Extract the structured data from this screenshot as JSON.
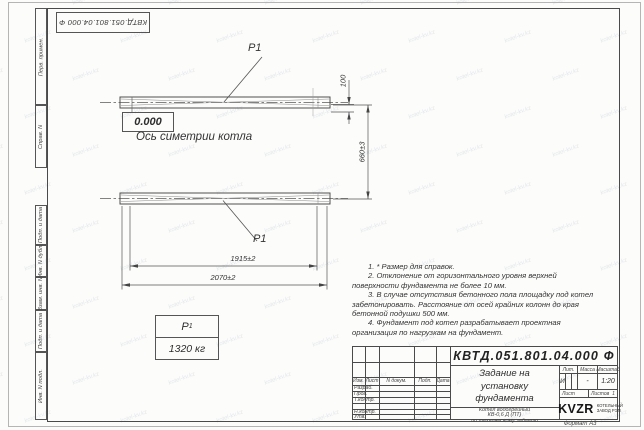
{
  "page": {
    "stamp_rotated": "КВТД.051.801.04.000  Ф",
    "format_label": "Формат А3",
    "watermark_text": "kotel-kv.kz"
  },
  "margin_labels": {
    "perv_primen": "Перв. примен.",
    "sprav_n": "Справ. N",
    "podp_data_1": "Подп. и дата",
    "inv_dubl": "Инв. N дубл.",
    "vzam_inv": "Взам. инв. N",
    "podp_data_2": "Подп. и дата",
    "inv_podl": "Инв. N подл."
  },
  "drawing": {
    "p1_top": "P1",
    "p1_bottom": "P1",
    "level_mark": "0.000",
    "axis_label": "Ось симетрии котла",
    "dims": {
      "inner_width": "1915±2",
      "outer_width": "2070±2",
      "vertical_gap": "660±3",
      "thickness": "100"
    },
    "mass_table": {
      "symbol": "P",
      "symbol_sub": "1",
      "value": "1320 кг"
    }
  },
  "notes": {
    "n1": "1. * Размер для справок.",
    "n2": "2. Отклонение от горизонтального уровня верхней поверхности фундамента не более 10 мм.",
    "n3": "3. В случае отсутствия бетонного пола площадку под котел забетонировать. Расстояние от осей крайних колонн до края бетонной подушки 500 мм.",
    "n4": "4. Фундамент под котел разрабатывает проектная организация по нагрузкам на фундамент."
  },
  "title_block": {
    "doc_number": "КВТД.051.801.04.000  Ф",
    "title_lines": {
      "l1": "Задание на",
      "l2": "установку",
      "l3": "фундамента"
    },
    "subtitle_lines": {
      "l1": "Котел водогрейный",
      "l2": "КВ-0,6 Д (ПТ)",
      "l3": "по техническому заданию"
    },
    "col_headers": {
      "izm": "Изм.",
      "list": "Лист",
      "doc": "N докум.",
      "podp": "Подп.",
      "data": "Дата"
    },
    "row_labels": {
      "razrab": "Разраб.",
      "prov": "Пров.",
      "tkontr": "Т.контр.",
      "nkontr": "Н.контр.",
      "utv": "Утв."
    },
    "lit_header": "Лит.",
    "mass_header": "Масса",
    "scale_header": "Масштаб",
    "lit_value": "И",
    "mass_value": "-",
    "scale_value": "1:20",
    "sheet_label": "Лист",
    "sheets_label": "Листов",
    "sheets_value": "1",
    "logo_text": "KVZR",
    "logo_caption": {
      "l1": "КОТЕЛЬНЫЙ",
      "l2": "ЗАВОД РЭП"
    }
  }
}
